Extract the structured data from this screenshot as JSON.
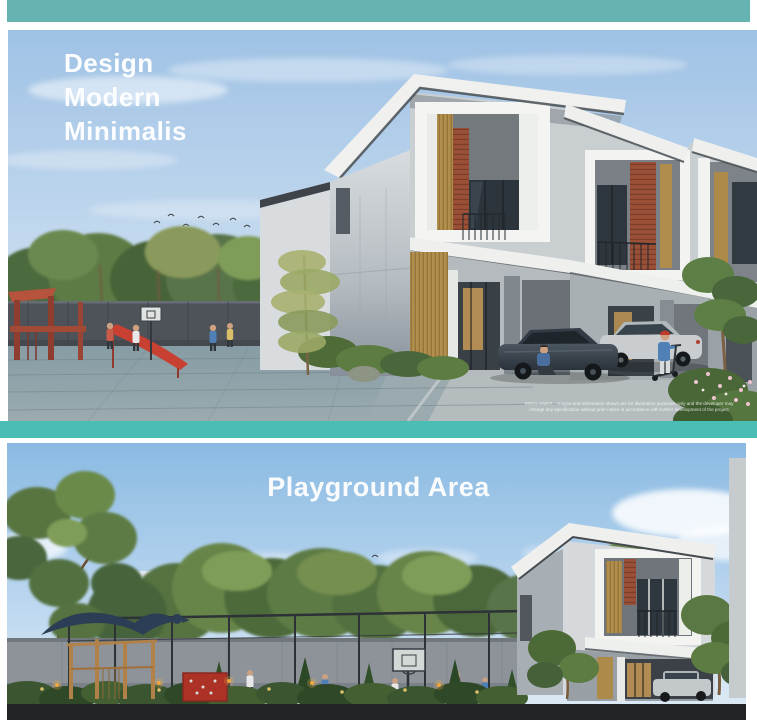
{
  "page": {
    "background": "#ffffff",
    "accent_teal_top": "#66b3b1",
    "accent_teal_divider": "#4abdb5"
  },
  "panel_design": {
    "alt": "Architectural render of modern minimalist two-storey row houses with playground plaza, parked cars and residents",
    "title_lines": [
      "Design",
      "Modern",
      "Minimalis"
    ],
    "disclaimer": {
      "line1": "DISCLAIMER : Images and information shown are for illustration purposes only and the developer may",
      "line2": "change any specification without prior notice in accordance with further development of the project"
    }
  },
  "panel_playground": {
    "alt": "Architectural render of fenced playground area with basketball court, timber play structure, hedges and a modern house",
    "title": "Playground Area"
  }
}
